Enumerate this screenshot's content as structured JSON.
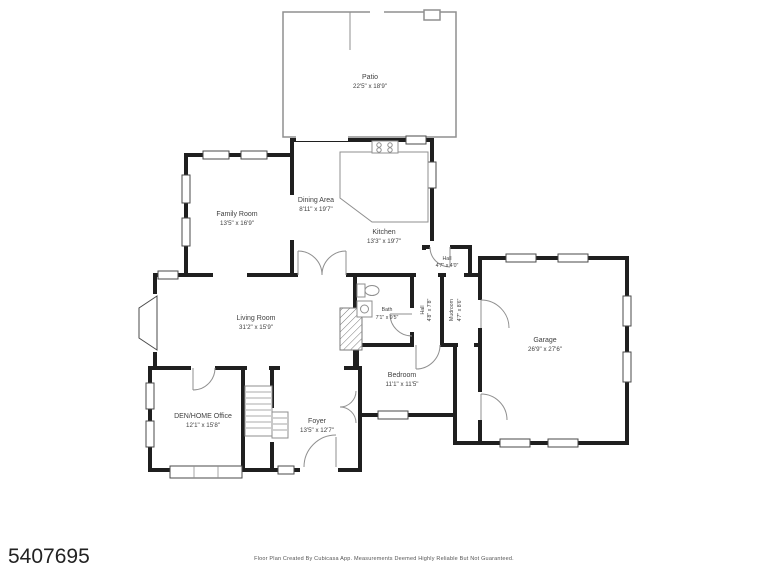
{
  "page": {
    "listing_id": "5407695",
    "credit": "Floor Plan Created By Cubicasa App. Measurements Deemed Highly Reliable But Not Guaranteed."
  },
  "colors": {
    "wall": "#1f1f1f",
    "line": "#8f8f8f",
    "text": "#3f3f3f",
    "background": "#ffffff"
  },
  "rooms": {
    "patio": {
      "name": "Patio",
      "dims": "22'5\" x 18'9\""
    },
    "family_room": {
      "name": "Family Room",
      "dims": "13'5\" x 16'9\""
    },
    "dining_area": {
      "name": "Dining Area",
      "dims": "8'11\" x 19'7\""
    },
    "kitchen": {
      "name": "Kitchen",
      "dims": "13'3\" x 19'7\""
    },
    "hall_top": {
      "name": "Hall",
      "dims": "4'7\" x 4'0\""
    },
    "hall_side": {
      "name": "Hall",
      "dims": "4'8\" x 7'8\""
    },
    "mudroom": {
      "name": "Mudroom",
      "dims": "4'7\" x 8'6\""
    },
    "bath": {
      "name": "Bath",
      "dims": "7'1\" x 9'5\""
    },
    "living_room": {
      "name": "Living Room",
      "dims": "31'2\" x 15'9\""
    },
    "garage": {
      "name": "Garage",
      "dims": "26'9\" x 27'6\""
    },
    "bedroom": {
      "name": "Bedroom",
      "dims": "11'1\" x 11'5\""
    },
    "foyer": {
      "name": "Foyer",
      "dims": "13'5\" x 12'7\""
    },
    "den": {
      "name": "DEN/HOME Office",
      "dims": "12'1\" x 15'8\""
    }
  }
}
